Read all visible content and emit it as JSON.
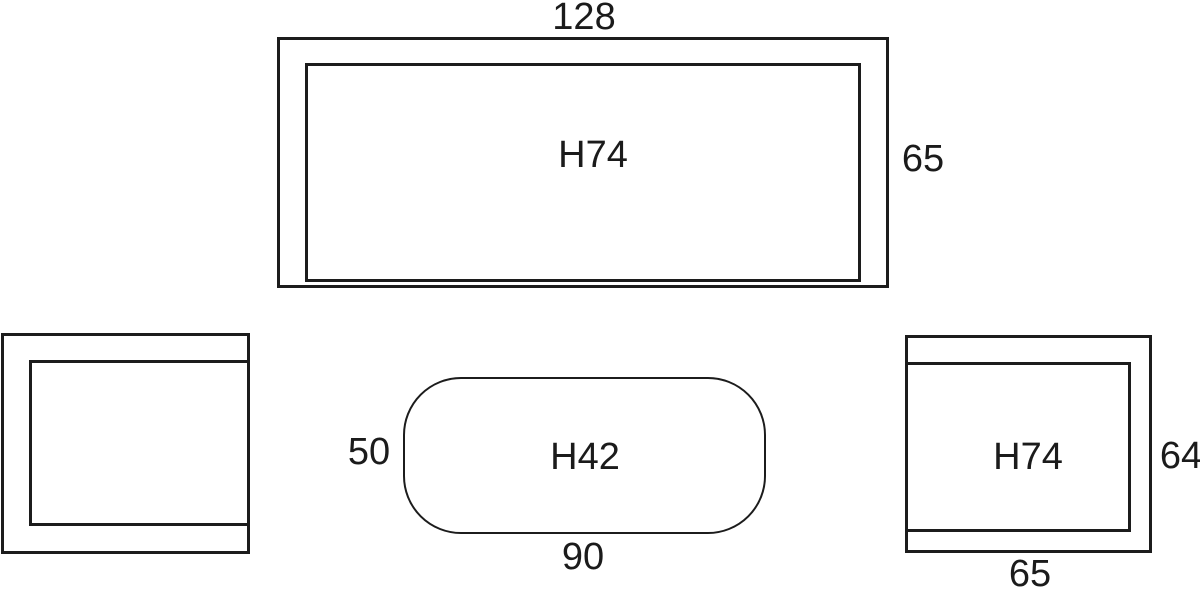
{
  "colors": {
    "background": "#ffffff",
    "line": "#1c1c1c",
    "text": "#1b1b1b"
  },
  "desk_front": {
    "width": "128",
    "height": "H74",
    "side": "65"
  },
  "coffee_table": {
    "depth": "50",
    "height": "H42",
    "width": "90"
  },
  "side_view": {
    "height": "H74",
    "depth": "64",
    "width": "65"
  }
}
